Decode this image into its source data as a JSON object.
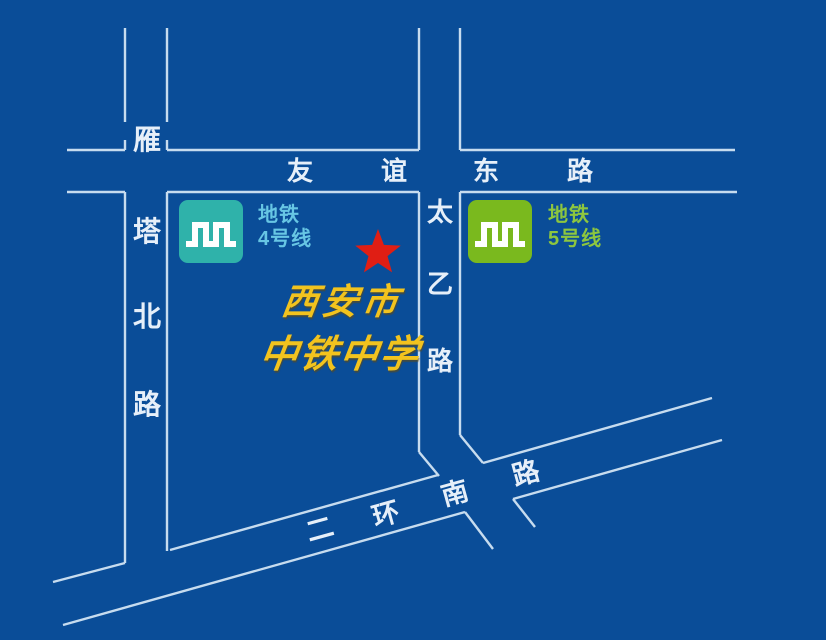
{
  "map": {
    "title": "西安市中铁中学位置示意图",
    "background_color": "#0a4d98",
    "road_line_color": "#c7dcef",
    "road_label_color": "#e6eff9"
  },
  "roads": {
    "yanta_north": {
      "name": "雁塔北路",
      "chars": [
        "雁",
        "塔",
        "北",
        "路"
      ]
    },
    "youyi_east": {
      "name": "友谊东路",
      "chars": [
        "友",
        "谊",
        "东",
        "路"
      ]
    },
    "taiyi": {
      "name": "太乙路",
      "chars": [
        "太",
        "乙",
        "路"
      ]
    },
    "erhuan_south": {
      "name": "二环南路",
      "chars": [
        "二",
        "环",
        "南",
        "路"
      ]
    }
  },
  "metro_legend": {
    "line4": {
      "title": "地铁",
      "subtitle": "4号线",
      "badge_color": "#2fb2aa",
      "text_color": "#67c6e4",
      "icon": "xian-metro-logo"
    },
    "line5": {
      "title": "地铁",
      "subtitle": "5号线",
      "badge_color": "#7ab91e",
      "text_color": "#8dc63f",
      "icon": "xian-metro-logo"
    }
  },
  "poi": {
    "marker_icon": "red-star",
    "marker_color": "#e01e14",
    "name_line1": "西安市",
    "name_line2": "中铁中学",
    "name_color": "#f2c31e"
  }
}
